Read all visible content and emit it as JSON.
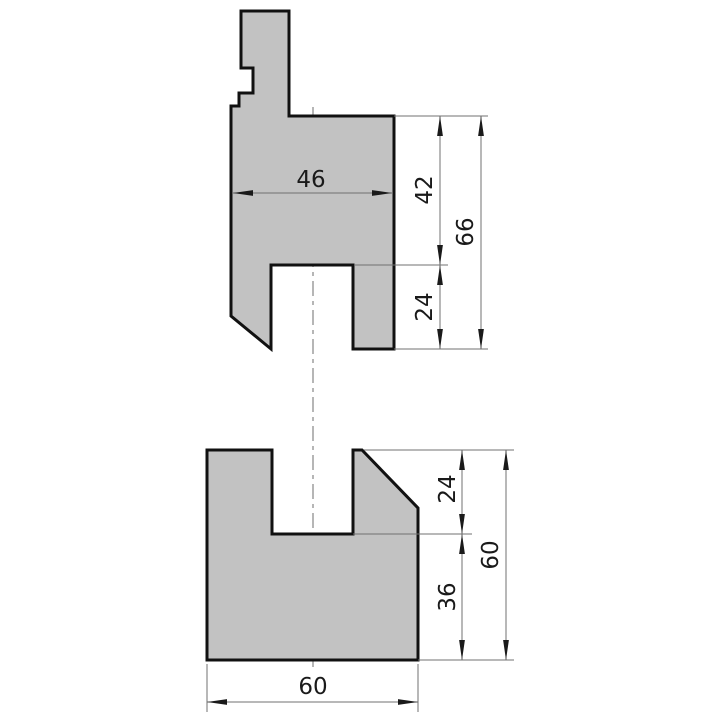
{
  "drawing": {
    "kind": "press-brake-tooling-technical-drawing",
    "views": {
      "punch": {
        "name": "upper punch",
        "dims": {
          "width": "46",
          "upper_height": "42",
          "groove_height": "24",
          "total_height": "66"
        }
      },
      "die": {
        "name": "lower die",
        "dims": {
          "slot_depth": "24",
          "base_height": "36",
          "total_height": "60",
          "width": "60"
        }
      }
    },
    "colors": {
      "page_bg": "#ffffff",
      "part_fill": "#c2c2c2",
      "part_outline": "#111111",
      "dim_line": "#707070",
      "centerline": "#6e6e6e",
      "dim_text": "#1a1a1a"
    }
  }
}
